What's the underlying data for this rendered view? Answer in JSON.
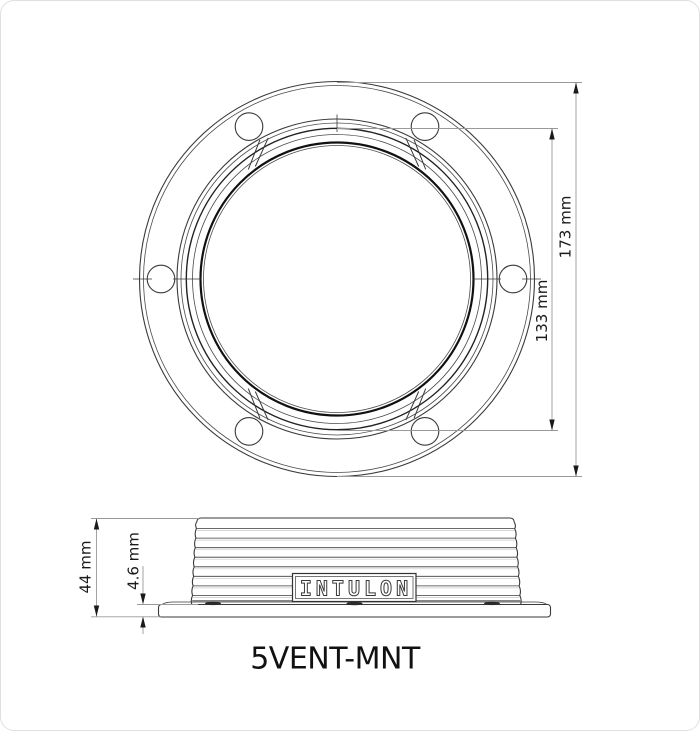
{
  "title": "5VENT-MNT",
  "top_view": {
    "outer_diameter": "173 mm",
    "inner_diameter": "133 mm"
  },
  "side_view": {
    "height": "44 mm",
    "flange_thickness": "4.6 mm",
    "brand": "INTULON"
  },
  "colors": {
    "background": "#ffffff",
    "card_border": "#e0e0e0",
    "part_line": "#3a3a3a",
    "dark_line": "#111111",
    "dimension_line": "#999999",
    "text": "#1a1a1a"
  }
}
